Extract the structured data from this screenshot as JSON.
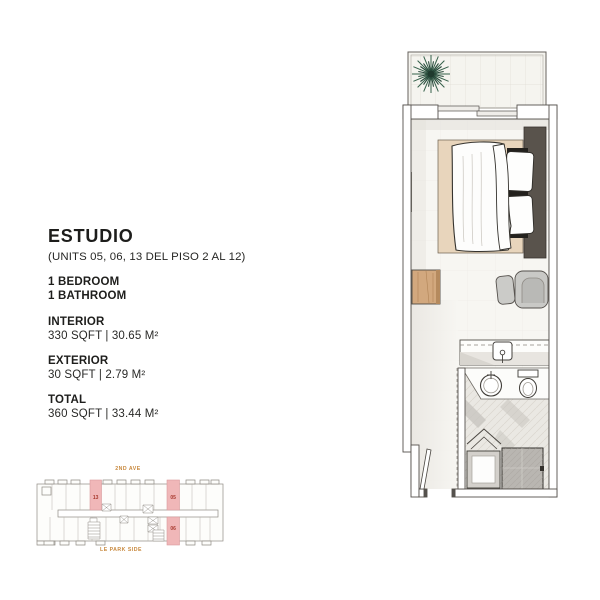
{
  "page": {
    "background_color": "#ffffff"
  },
  "info_panel": {
    "title": "ESTUDIO",
    "subtitle": "(UNITS 05, 06, 13 DEL PISO 2 AL 12)",
    "features": [
      "1 BEDROOM",
      "1 BATHROOM"
    ],
    "sections": [
      {
        "label": "INTERIOR",
        "value": "330 SQFT | 30.65 M²"
      },
      {
        "label": "EXTERIOR",
        "value": "30 SQFT | 2.79 M²"
      },
      {
        "label": "TOTAL",
        "value": "360 SQFT | 33.44 M²"
      }
    ]
  },
  "key_plan": {
    "street_top": "2ND AVE",
    "street_bottom": "LE PARK SIDE",
    "units": [
      {
        "number": "13"
      },
      {
        "number": "05"
      },
      {
        "number": "06"
      }
    ],
    "colors": {
      "unit_fill": "#f0b7b8",
      "unit_border": "#d99a9b",
      "unit_text": "#a8392e",
      "street_text": "#c8883d",
      "outline": "#8f8b84"
    }
  },
  "floor_plan": {
    "features": [
      "balcony",
      "plant",
      "sliding-door",
      "bed",
      "rug",
      "headboard",
      "pillows",
      "side-table",
      "armchair",
      "ottoman",
      "kitchenette-counter",
      "sink",
      "vanity-basin",
      "toilet",
      "folding-door",
      "shower",
      "shower-tray",
      "entry-door",
      "hallway"
    ],
    "colors": {
      "wall": "#55514d",
      "floor": "#f7f6f2",
      "rug": "#e8d5bc",
      "wood": "#d2a87e",
      "plant": "#35604a",
      "upholstery": "#c9c9c6",
      "shower": "#b9b6b1"
    }
  }
}
